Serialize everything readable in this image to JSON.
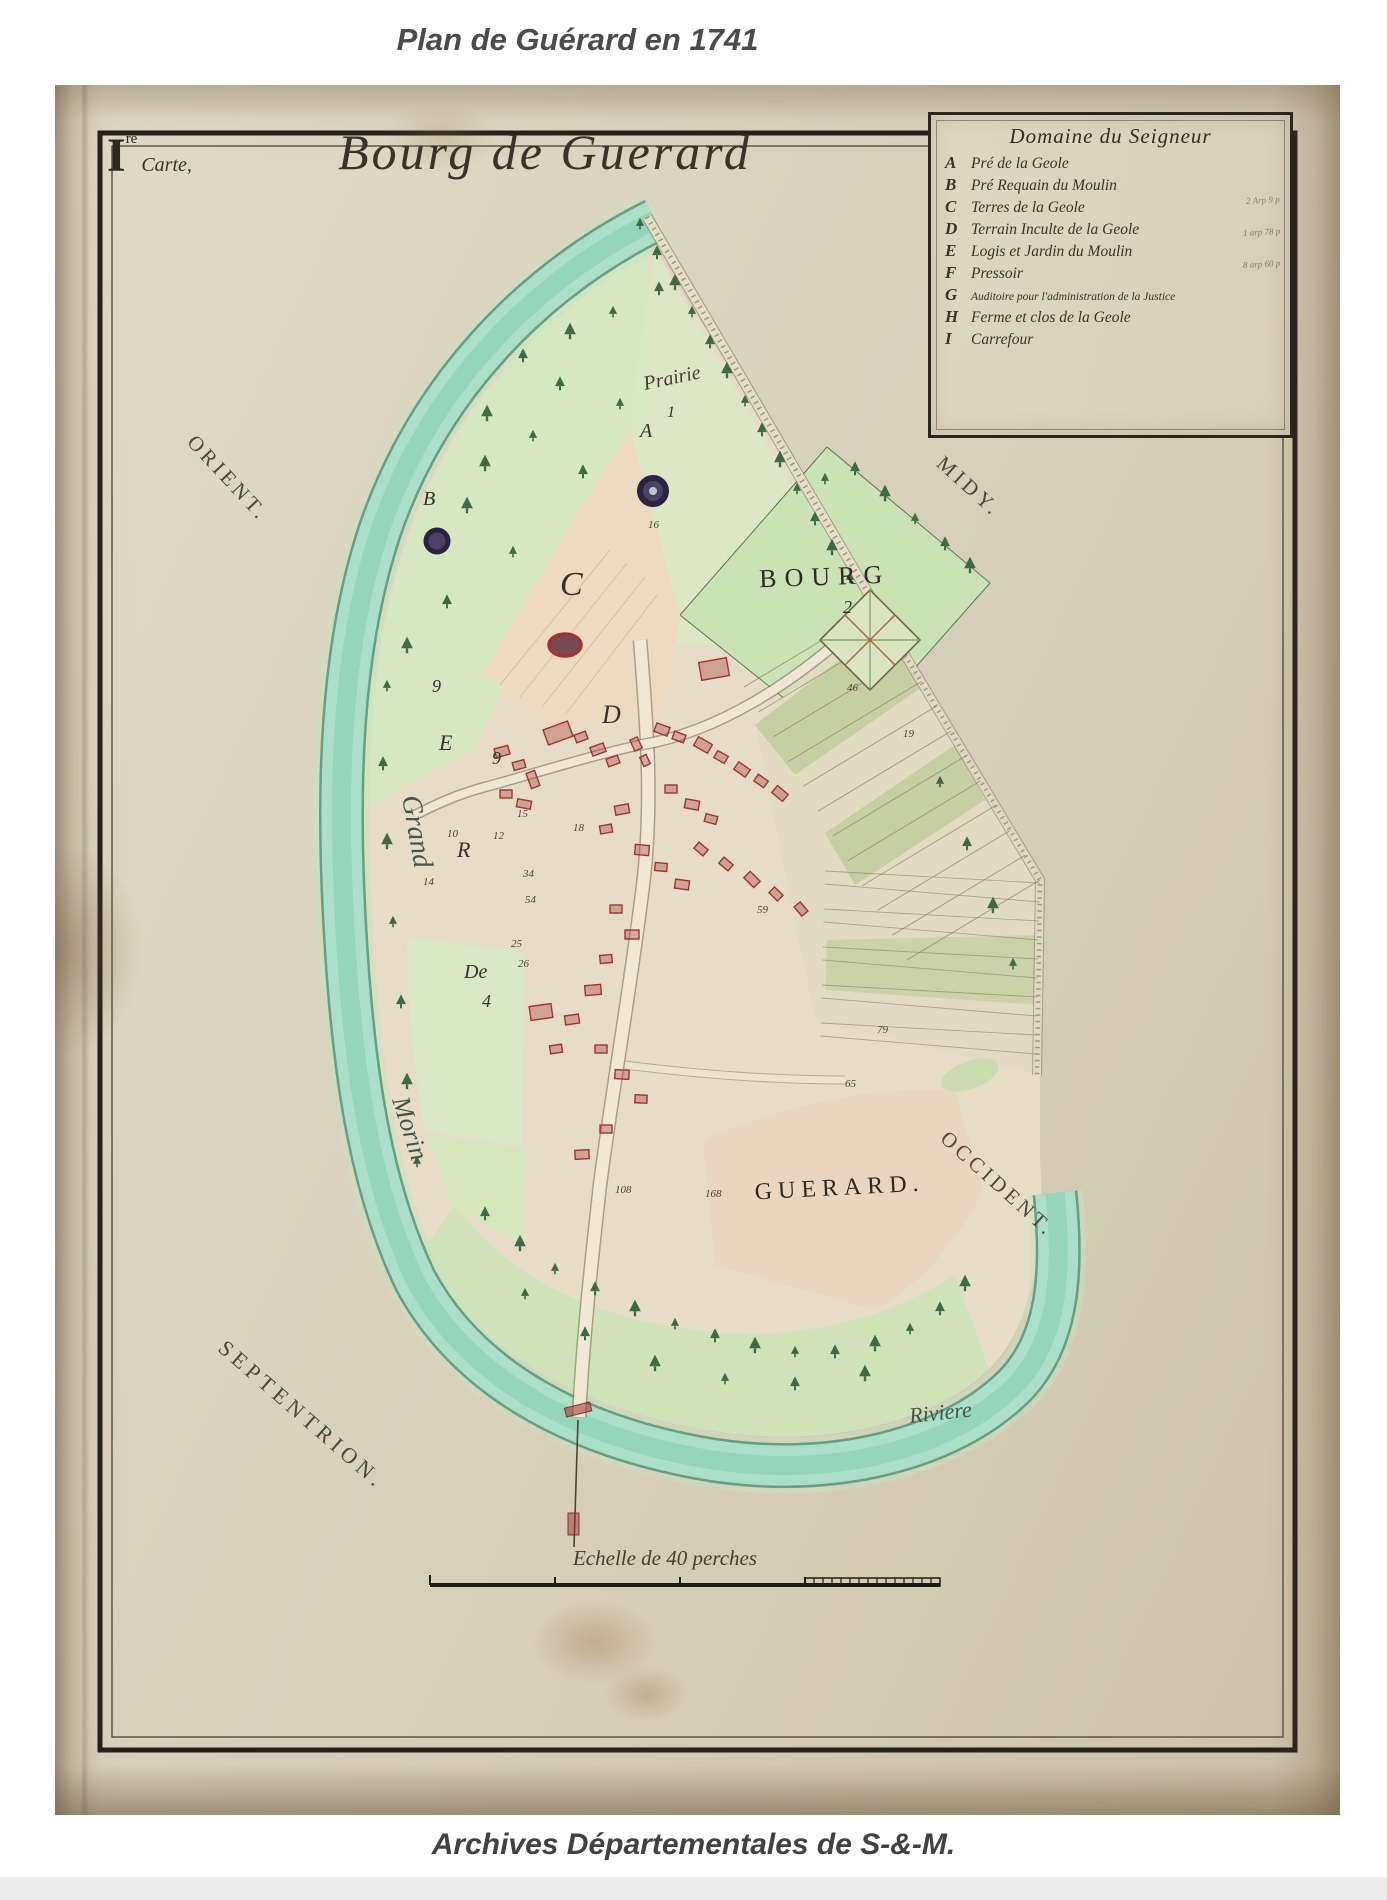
{
  "page": {
    "title": "Plan de Guérard en 1741",
    "caption": "Archives Départementales de S-&-M."
  },
  "photo": {
    "folio_numeral": "I",
    "folio_sup": "re",
    "folio_word": "Carte,",
    "map_title": "Bourg de Guerard",
    "legend": {
      "title": "Domaine du Seigneur",
      "entries": [
        {
          "key": "A",
          "label": "Pré de la Geole"
        },
        {
          "key": "B",
          "label": "Pré Requain du Moulin"
        },
        {
          "key": "C",
          "label": "Terres de la Geole"
        },
        {
          "key": "D",
          "label": "Terrain Inculte de la Geole"
        },
        {
          "key": "E",
          "label": "Logis et Jardin du Moulin"
        },
        {
          "key": "F",
          "label": "Pressoir"
        },
        {
          "key": "G",
          "label": "Auditoire pour l'administration de la Justice"
        },
        {
          "key": "H",
          "label": "Ferme et clos de la Geole"
        },
        {
          "key": "I",
          "label": "Carrefour"
        }
      ],
      "notes": [
        "2 Arp 9 p",
        "1 arp 78 p",
        "8 arp 60 p"
      ]
    },
    "compass": {
      "orient": "ORIENT.",
      "midy": "MIDY.",
      "septentrion": "SEPTENTRION.",
      "occident": "OCCIDENT."
    },
    "water": {
      "river_upper": "Grand",
      "river_lower": "Morin",
      "river_word": "Riviere"
    },
    "places": {
      "prairie": "Prairie",
      "bourg": "BOURG",
      "bourg_num": "2",
      "guerard": "GUERARD."
    },
    "parcels": {
      "a": "A",
      "b": "B",
      "c": "C",
      "d": "D",
      "e": "E",
      "r": "R",
      "de": "De",
      "four": "4",
      "one": "1",
      "nine1": "9",
      "nine2": "9"
    },
    "numbers": [
      "16",
      "10",
      "12",
      "15",
      "14",
      "18",
      "34",
      "54",
      "25",
      "26",
      "59",
      "19",
      "46",
      "79",
      "65",
      "108",
      "168"
    ],
    "scale_label": "Echelle de 40 perches",
    "colors": {
      "paper": "#d8d0bc",
      "river": "#abdfc9",
      "ink": "#2b261e",
      "building_red": "#a03434",
      "field_green": "#cde3b6"
    }
  }
}
